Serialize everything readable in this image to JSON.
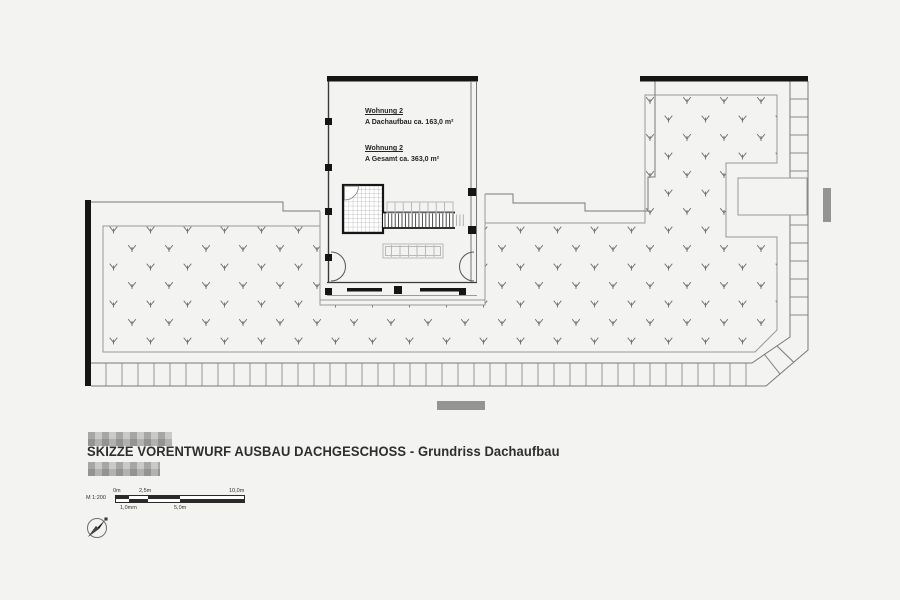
{
  "title_block": {
    "title": "SKIZZE VORENTWURF AUSBAU DACHGESCHOSS - Grundriss Dachaufbau"
  },
  "apartment_labels": [
    {
      "name": "Wohnung 2",
      "area": "A Dachaufbau ca. 163,0 m²"
    },
    {
      "name": "Wohnung 2",
      "area": "A Gesamt ca. 363,0 m²"
    }
  ],
  "scale_bar": {
    "scale_label": "M 1:200",
    "ticks_top": [
      "0m",
      "2,5m",
      "10,0m"
    ],
    "ticks_bottom": [
      "1,0mm",
      "5,0m"
    ]
  },
  "icons": {
    "north_arrow": "compass-north-arrow"
  },
  "plan": {
    "colors": {
      "wall": "#151515",
      "outline": "#7a7a7a",
      "thin": "#9a9a9a",
      "marks": "#6e6e6e",
      "paper": "#f3f3f1"
    },
    "green_path": "M103,226 L320,226 L320,305 L485,305 L485,223 L645,223 L645,95 L777,95 L777,163 L726,163 L726,237 L777,237 L777,330 L755,352 L103,352 Z",
    "vegetation_marks": {
      "x0": 95,
      "x1": 788,
      "y0": 101,
      "y1": 351,
      "dx": 37,
      "dy": 18.5,
      "row_offset": 18.5
    },
    "line_series": [
      {
        "target": "g-rungs",
        "orient": "v",
        "a0": 106,
        "a1": 748,
        "step": 16,
        "b0": 363.5,
        "b1": 385.5,
        "stroke": "#8a8a8a",
        "w": 0.9
      },
      {
        "target": "g-rungs",
        "orient": "h",
        "a0": 99,
        "a1": 331,
        "step": 18,
        "b0": 790,
        "b1": 807.5,
        "stroke": "#8a8a8a",
        "w": 0.9
      },
      {
        "target": "g-detail",
        "orient": "v",
        "a0": 385,
        "a1": 453.5,
        "step": 3.4,
        "b0": 213.5,
        "b1": 227,
        "stroke": "#3a3a3a",
        "w": 0.9
      },
      {
        "target": "g-detail",
        "orient": "v",
        "a0": 456.5,
        "a1": 466,
        "step": 3.4,
        "b0": 214.5,
        "b1": 226,
        "stroke": "#aaaaaa",
        "w": 0.9
      },
      {
        "target": "g-detail",
        "orient": "v",
        "a0": 395,
        "a1": 452,
        "step": 8.25,
        "b0": 202.5,
        "b1": 212.5,
        "stroke": "#b8b8b8",
        "w": 1
      },
      {
        "target": "g-detail",
        "orient": "v",
        "a0": 391.5,
        "a1": 440,
        "step": 8.5,
        "b0": 245,
        "b1": 257,
        "stroke": "#b8b8b8",
        "w": 1
      }
    ]
  }
}
